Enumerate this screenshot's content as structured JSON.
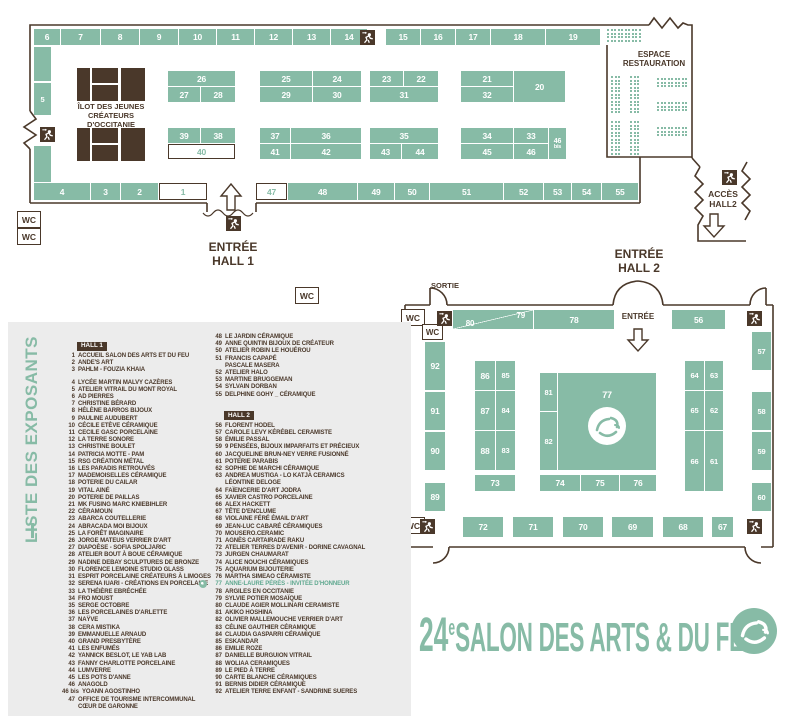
{
  "labels": {
    "wc": "WC",
    "sortie": "SORTIE",
    "entree": "ENTRÉE",
    "espace1": "ESPACE",
    "espace2": "RESTAURATION",
    "acces1": "ACCÈS",
    "acces2": "HALL2",
    "eh1a": "ENTRÉE",
    "eh1b": "HALL 1",
    "eh2a": "ENTRÉE",
    "eh2b": "HALL 2",
    "ilot1": "ÎLOT DES JEUNES",
    "ilot2": "CRÉATEURS D'OCCITANIE"
  },
  "hall1": {
    "booths": [
      {
        "n": "6",
        "x": 34,
        "y": 29,
        "w": 26,
        "h": 16
      },
      {
        "n": "7",
        "x": 61,
        "y": 29,
        "w": 39,
        "h": 16
      },
      {
        "n": "8",
        "x": 101,
        "y": 29,
        "w": 38,
        "h": 16
      },
      {
        "n": "9",
        "x": 140,
        "y": 29,
        "w": 38,
        "h": 16
      },
      {
        "n": "10",
        "x": 179,
        "y": 29,
        "w": 37,
        "h": 16
      },
      {
        "n": "11",
        "x": 217,
        "y": 29,
        "w": 37,
        "h": 16
      },
      {
        "n": "12",
        "x": 255,
        "y": 29,
        "w": 37,
        "h": 16
      },
      {
        "n": "13",
        "x": 293,
        "y": 29,
        "w": 37,
        "h": 16
      },
      {
        "n": "14",
        "x": 331,
        "y": 29,
        "w": 36,
        "h": 16
      },
      {
        "n": "15",
        "x": 386,
        "y": 29,
        "w": 34,
        "h": 16
      },
      {
        "n": "16",
        "x": 421,
        "y": 29,
        "w": 34,
        "h": 16
      },
      {
        "n": "17",
        "x": 456,
        "y": 29,
        "w": 34,
        "h": 16
      },
      {
        "n": "18",
        "x": 491,
        "y": 29,
        "w": 54,
        "h": 16
      },
      {
        "n": "19",
        "x": 546,
        "y": 29,
        "w": 54,
        "h": 16
      },
      {
        "n": "",
        "x": 34,
        "y": 47,
        "w": 17,
        "h": 34
      },
      {
        "n": "5",
        "x": 34,
        "y": 83,
        "w": 17,
        "h": 32
      },
      {
        "n": "",
        "x": 34,
        "y": 146,
        "w": 17,
        "h": 36
      },
      {
        "n": "4",
        "x": 34,
        "y": 183,
        "w": 56,
        "h": 17
      },
      {
        "n": "3",
        "x": 91,
        "y": 183,
        "w": 29,
        "h": 17
      },
      {
        "n": "2",
        "x": 121,
        "y": 183,
        "w": 37,
        "h": 17
      },
      {
        "n": "1",
        "x": 159,
        "y": 183,
        "w": 48,
        "h": 17,
        "v": "w"
      },
      {
        "n": "47",
        "x": 256,
        "y": 183,
        "w": 31,
        "h": 17,
        "v": "w"
      },
      {
        "n": "48",
        "x": 288,
        "y": 183,
        "w": 69,
        "h": 17
      },
      {
        "n": "49",
        "x": 358,
        "y": 183,
        "w": 36,
        "h": 17
      },
      {
        "n": "50",
        "x": 395,
        "y": 183,
        "w": 34,
        "h": 17
      },
      {
        "n": "51",
        "x": 430,
        "y": 183,
        "w": 73,
        "h": 17
      },
      {
        "n": "52",
        "x": 504,
        "y": 183,
        "w": 39,
        "h": 17
      },
      {
        "n": "53",
        "x": 544,
        "y": 183,
        "w": 27,
        "h": 17
      },
      {
        "n": "54",
        "x": 572,
        "y": 183,
        "w": 29,
        "h": 17
      },
      {
        "n": "55",
        "x": 602,
        "y": 183,
        "w": 36,
        "h": 17
      },
      {
        "n": "26",
        "x": 168,
        "y": 71,
        "w": 67,
        "h": 15
      },
      {
        "n": "27",
        "x": 168,
        "y": 87,
        "w": 32,
        "h": 15
      },
      {
        "n": "28",
        "x": 201,
        "y": 87,
        "w": 34,
        "h": 15
      },
      {
        "n": "25",
        "x": 260,
        "y": 71,
        "w": 52,
        "h": 15
      },
      {
        "n": "24",
        "x": 313,
        "y": 71,
        "w": 48,
        "h": 15
      },
      {
        "n": "29",
        "x": 260,
        "y": 87,
        "w": 52,
        "h": 15
      },
      {
        "n": "30",
        "x": 313,
        "y": 87,
        "w": 48,
        "h": 15
      },
      {
        "n": "23",
        "x": 370,
        "y": 71,
        "w": 33,
        "h": 15
      },
      {
        "n": "22",
        "x": 404,
        "y": 71,
        "w": 34,
        "h": 15
      },
      {
        "n": "31",
        "x": 370,
        "y": 87,
        "w": 68,
        "h": 15
      },
      {
        "n": "21",
        "x": 461,
        "y": 71,
        "w": 52,
        "h": 15
      },
      {
        "n": "32",
        "x": 461,
        "y": 87,
        "w": 52,
        "h": 15
      },
      {
        "n": "20",
        "x": 514,
        "y": 71,
        "w": 51,
        "h": 31
      },
      {
        "n": "39",
        "x": 168,
        "y": 128,
        "w": 32,
        "h": 15
      },
      {
        "n": "38",
        "x": 201,
        "y": 128,
        "w": 34,
        "h": 15
      },
      {
        "n": "40",
        "x": 168,
        "y": 144,
        "w": 67,
        "h": 15,
        "v": "w"
      },
      {
        "n": "37",
        "x": 260,
        "y": 128,
        "w": 30,
        "h": 15
      },
      {
        "n": "36",
        "x": 291,
        "y": 128,
        "w": 70,
        "h": 15
      },
      {
        "n": "41",
        "x": 260,
        "y": 144,
        "w": 30,
        "h": 15
      },
      {
        "n": "42",
        "x": 291,
        "y": 144,
        "w": 70,
        "h": 15
      },
      {
        "n": "35",
        "x": 370,
        "y": 128,
        "w": 68,
        "h": 15
      },
      {
        "n": "43",
        "x": 370,
        "y": 144,
        "w": 31,
        "h": 15
      },
      {
        "n": "44",
        "x": 402,
        "y": 144,
        "w": 36,
        "h": 15
      },
      {
        "n": "34",
        "x": 461,
        "y": 128,
        "w": 52,
        "h": 15
      },
      {
        "n": "33",
        "x": 514,
        "y": 128,
        "w": 34,
        "h": 15
      },
      {
        "n": "45",
        "x": 461,
        "y": 144,
        "w": 52,
        "h": 15
      },
      {
        "n": "46",
        "x": 514,
        "y": 144,
        "w": 34,
        "h": 15
      },
      {
        "n": "46",
        "sub": "bis",
        "x": 549,
        "y": 128,
        "w": 17,
        "h": 31
      }
    ]
  },
  "hall2": {
    "booths": [
      {
        "n": "80",
        "n2": "79",
        "x": 453,
        "y": 310,
        "w": 80,
        "h": 19,
        "diag": true
      },
      {
        "n": "78",
        "x": 534,
        "y": 310,
        "w": 80,
        "h": 19
      },
      {
        "n": "56",
        "x": 672,
        "y": 310,
        "w": 53,
        "h": 19
      },
      {
        "n": "92",
        "x": 425,
        "y": 342,
        "w": 20,
        "h": 48
      },
      {
        "n": "91",
        "x": 425,
        "y": 392,
        "w": 20,
        "h": 38
      },
      {
        "n": "90",
        "x": 425,
        "y": 432,
        "w": 20,
        "h": 38
      },
      {
        "n": "89",
        "x": 425,
        "y": 483,
        "w": 20,
        "h": 28
      },
      {
        "n": "86",
        "x": 475,
        "y": 361,
        "w": 20,
        "h": 29
      },
      {
        "n": "85",
        "x": 496,
        "y": 361,
        "w": 19,
        "h": 29
      },
      {
        "n": "87",
        "x": 475,
        "y": 391,
        "w": 20,
        "h": 39
      },
      {
        "n": "84",
        "x": 496,
        "y": 391,
        "w": 19,
        "h": 39
      },
      {
        "n": "88",
        "x": 475,
        "y": 431,
        "w": 20,
        "h": 39
      },
      {
        "n": "83",
        "x": 496,
        "y": 431,
        "w": 19,
        "h": 39
      },
      {
        "n": "73",
        "x": 475,
        "y": 475,
        "w": 40,
        "h": 16
      },
      {
        "n": "81",
        "x": 540,
        "y": 373,
        "w": 17,
        "h": 38
      },
      {
        "n": "82",
        "x": 540,
        "y": 412,
        "w": 17,
        "h": 58
      },
      {
        "n": "77",
        "x": 558,
        "y": 373,
        "w": 98,
        "h": 97,
        "logo": true
      },
      {
        "n": "74",
        "x": 540,
        "y": 475,
        "w": 40,
        "h": 16
      },
      {
        "n": "75",
        "x": 581,
        "y": 475,
        "w": 38,
        "h": 16
      },
      {
        "n": "76",
        "x": 620,
        "y": 475,
        "w": 36,
        "h": 16
      },
      {
        "n": "64",
        "x": 685,
        "y": 361,
        "w": 19,
        "h": 29
      },
      {
        "n": "63",
        "x": 705,
        "y": 361,
        "w": 18,
        "h": 29
      },
      {
        "n": "65",
        "x": 685,
        "y": 391,
        "w": 19,
        "h": 39
      },
      {
        "n": "62",
        "x": 705,
        "y": 391,
        "w": 18,
        "h": 39
      },
      {
        "n": "66",
        "x": 685,
        "y": 431,
        "w": 19,
        "h": 60
      },
      {
        "n": "61",
        "x": 705,
        "y": 431,
        "w": 18,
        "h": 60
      },
      {
        "n": "57",
        "x": 752,
        "y": 332,
        "w": 19,
        "h": 38
      },
      {
        "n": "58",
        "x": 752,
        "y": 392,
        "w": 19,
        "h": 38
      },
      {
        "n": "59",
        "x": 752,
        "y": 432,
        "w": 19,
        "h": 38
      },
      {
        "n": "60",
        "x": 752,
        "y": 483,
        "w": 19,
        "h": 28
      },
      {
        "n": "72",
        "x": 463,
        "y": 517,
        "w": 40,
        "h": 20
      },
      {
        "n": "71",
        "x": 513,
        "y": 517,
        "w": 40,
        "h": 20
      },
      {
        "n": "70",
        "x": 563,
        "y": 517,
        "w": 40,
        "h": 20
      },
      {
        "n": "69",
        "x": 612,
        "y": 517,
        "w": 41,
        "h": 20
      },
      {
        "n": "68",
        "x": 663,
        "y": 517,
        "w": 40,
        "h": 20
      },
      {
        "n": "67",
        "x": 712,
        "y": 517,
        "w": 21,
        "h": 20
      }
    ]
  },
  "list": {
    "title": "LISTE DES EXPOSANTS",
    "col1": [
      {
        "h": "HALL 1"
      },
      {
        "n": "1",
        "t": "ACCUEIL SALON DES ARTS ET DU FEU"
      },
      {
        "n": "2",
        "t": "ANDE'S ART"
      },
      {
        "n": "3",
        "t": "PAHLM - FOUZIA KHAIA"
      },
      {
        "gap": true
      },
      {
        "n": "4",
        "t": "LYCÉE MARTIN MALVY CAZÈRES"
      },
      {
        "n": "5",
        "t": "ATELIER VITRAIL DU MONT ROYAL"
      },
      {
        "n": "6",
        "t": "AD PIERRES"
      },
      {
        "n": "7",
        "t": "CHRISTINE BÉRARD"
      },
      {
        "n": "8",
        "t": "HÉLÈNE BARROS BIJOUX"
      },
      {
        "n": "9",
        "t": "PAULINE AUDUBERT"
      },
      {
        "n": "10",
        "t": "CÉCILE ETÈVE CÉRAMIQUE"
      },
      {
        "n": "11",
        "t": "CECILE GASC PORCELAINE"
      },
      {
        "n": "12",
        "t": "LA TERRE SONORE"
      },
      {
        "n": "13",
        "t": "CHRISTINE BOULET"
      },
      {
        "n": "14",
        "t": "PATRICIA MOTTE - PAM"
      },
      {
        "n": "15",
        "t": "RSG CRÉATION MÉTAL"
      },
      {
        "n": "16",
        "t": "LES PARADIS RETROUVÉS"
      },
      {
        "n": "17",
        "t": "MADEMOISELLES CÉRAMIQUE"
      },
      {
        "n": "18",
        "t": "POTERIE DU CAILAR"
      },
      {
        "n": "19",
        "t": "VITAL AINÉ"
      },
      {
        "n": "20",
        "t": "POTERIE DE PAILLAS"
      },
      {
        "n": "21",
        "t": "MK FUSING MARC KNIEBIHLER"
      },
      {
        "n": "22",
        "t": "CÉRAMOUN"
      },
      {
        "n": "23",
        "t": "ABARCA COUTELLERIE"
      },
      {
        "n": "24",
        "t": "ABRACADA MOI BIJOUX"
      },
      {
        "n": "25",
        "t": "LA FORÊT IMAGINAIRE"
      },
      {
        "n": "26",
        "t": "JORGE MATEUS VERRIER D'ART"
      },
      {
        "n": "27",
        "t": "DIAPOÈSE - SOFIA SPOLJARIC"
      },
      {
        "n": "28",
        "t": "ATELIER BOUT À BOUE CÉRAMIQUE"
      },
      {
        "n": "29",
        "t": "NADINE DEBAY SCULPTURES DE BRONZE"
      },
      {
        "n": "30",
        "t": "FLORENCE LEMOINE STUDIO GLASS"
      },
      {
        "n": "31",
        "t": "ESPRIT PORCELAINE CRÉATEURS À LIMOGES"
      },
      {
        "n": "32",
        "t": "SERENA IUARI - CRÉATIONS EN PORCELAINE"
      },
      {
        "n": "33",
        "t": "LA THÉIÈRE EBRÉCHÉE"
      },
      {
        "n": "34",
        "t": "FRO MOUST"
      },
      {
        "n": "35",
        "t": "SERGE OCTOBRE"
      },
      {
        "n": "36",
        "t": "LES PORCELAINES D'ARLETTE"
      },
      {
        "n": "37",
        "t": "NAŸVE"
      },
      {
        "n": "38",
        "t": "CERA MISTIKA"
      },
      {
        "n": "39",
        "t": "EMMANUELLE ARNAUD"
      },
      {
        "n": "40",
        "t": "GRAND PRESBYTÈRE"
      },
      {
        "n": "41",
        "t": "LES ENFUMÉS"
      },
      {
        "n": "42",
        "t": "YANNICK BESLOT, LE YAB LAB"
      },
      {
        "n": "43",
        "t": "FANNY CHARLOTTE PORCELAINE"
      },
      {
        "n": "44",
        "t": "LUMVERRE"
      },
      {
        "n": "45",
        "t": "LES POTS D'ANNE"
      },
      {
        "n": "46",
        "t": "ANAGOLD"
      },
      {
        "n": "46 bis",
        "t": "YOANN AGOSTINHO"
      },
      {
        "n": "47",
        "t": "OFFICE DE TOURISME INTERCOMMUNAL"
      },
      {
        "n": "",
        "t": "CŒUR DE GARONNE"
      }
    ],
    "col2": [
      {
        "n": "48",
        "t": "LE JARDIN CÉRAMIQUE"
      },
      {
        "n": "49",
        "t": "ANNE QUINTIN BIJOUX DE CRÉATEUR"
      },
      {
        "n": "50",
        "t": "ATELIER ROBIN LE HOUÉROU"
      },
      {
        "n": "51",
        "t": "FRANCIS CAPAPÉ"
      },
      {
        "n": "",
        "t": "PASCALE MASERA"
      },
      {
        "n": "52",
        "t": "ATELIER HALO"
      },
      {
        "n": "53",
        "t": "MARTINE BRUGGEMAN"
      },
      {
        "n": "54",
        "t": "SYLVAIN DORBAN"
      },
      {
        "n": "55",
        "t": "DELPHINE GOHY _ CÉRAMIQUE"
      },
      {
        "gap": true
      },
      {
        "h": "HALL 2"
      },
      {
        "n": "56",
        "t": "FLORENT HODEL"
      },
      {
        "n": "57",
        "t": "CAROLE LEVY KÉRÉBEL CERAMISTE"
      },
      {
        "n": "58",
        "t": "ÉMILIE PASSAL"
      },
      {
        "n": "59",
        "t": "9 PENSÉES, BIJOUX IMPARFAITS ET PRÉCIEUX"
      },
      {
        "n": "60",
        "t": "JACQUELINE BRUN-NEY VERRE FUSIONNÉ"
      },
      {
        "n": "61",
        "t": "POTERIE PARABIS"
      },
      {
        "n": "62",
        "t": "SOPHIE DE MARCHI CÉRAMIQUE"
      },
      {
        "n": "63",
        "t": "ANDREA MUSTIGA - LO KATJA CERAMICS"
      },
      {
        "n": "",
        "t": "LÉONTINE DELOGE"
      },
      {
        "n": "64",
        "t": "FAÏENCERIE D'ART JODRA"
      },
      {
        "n": "65",
        "t": "XAVIER CASTRO PORCELAINE"
      },
      {
        "n": "66",
        "t": "ALEX HACKETT"
      },
      {
        "n": "67",
        "t": "TÊTE D'ENCLUME"
      },
      {
        "n": "68",
        "t": "VIOLAINE FÉRÉ ÉMAIL D'ART"
      },
      {
        "n": "69",
        "t": "JEAN-LUC CABARÉ CÉRAMIQUES"
      },
      {
        "n": "70",
        "t": "MOUSERO.CERAMIC"
      },
      {
        "n": "71",
        "t": "AGNÈS CARTAIRADE RAKU"
      },
      {
        "n": "72",
        "t": "ATELIER TERRES D'AVENIR - DORINE CAVAGNAL"
      },
      {
        "n": "73",
        "t": "JURGEN CHAUMARAT"
      },
      {
        "n": "74",
        "t": "ALICE NOUCHI CÉRAMIQUES"
      },
      {
        "n": "75",
        "t": "AQUARIUM BIJOUTERIE"
      },
      {
        "n": "76",
        "t": "MARTHA SIMEAO CÉRAMISTE"
      },
      {
        "n": "77",
        "t": "ANNE-LAURE PÉRÈS - INVITÉE D'HONNEUR",
        "hl": true,
        "icon": true
      },
      {
        "n": "78",
        "t": "ARGILES EN OCCITANIE"
      },
      {
        "n": "79",
        "t": "SYLVIE POTIER MOSAÏQUE"
      },
      {
        "n": "80",
        "t": "CLAUDE AGIER MOLLINARI CERAMISTE"
      },
      {
        "n": "81",
        "t": "AKIKO HOSHINA"
      },
      {
        "n": "82",
        "t": "OLIVIER MALLEMOUCHE VERRIER D'ART"
      },
      {
        "n": "83",
        "t": "CÉLINE GAUTHIER CÉRAMIQUE"
      },
      {
        "n": "84",
        "t": "CLAUDIA GASPARRI CÉRAMIQUE"
      },
      {
        "n": "85",
        "t": "ESKANDAR"
      },
      {
        "n": "86",
        "t": "EMILIE ROZE"
      },
      {
        "n": "87",
        "t": "DANIELLE BURGUION VITRAIL"
      },
      {
        "n": "88",
        "t": "WOLIAA CERAMIQUES"
      },
      {
        "n": "89",
        "t": "LE PIED À TERRE"
      },
      {
        "n": "90",
        "t": "CARTE BLANCHE CÉRAMIQUES"
      },
      {
        "n": "91",
        "t": "BERNIS DIDIER CÉRAMIQUE"
      },
      {
        "n": "92",
        "t": "ATELIER TERRE ENFANT - SANDRINE SUERES"
      }
    ]
  },
  "footer": {
    "edition": "24",
    "suffix": "e",
    "title": "SALON DES ARTS & DU FEU"
  },
  "colors": {
    "teal": "#87BBA6",
    "brown": "#4A382A",
    "panel": "#ECECEC"
  }
}
